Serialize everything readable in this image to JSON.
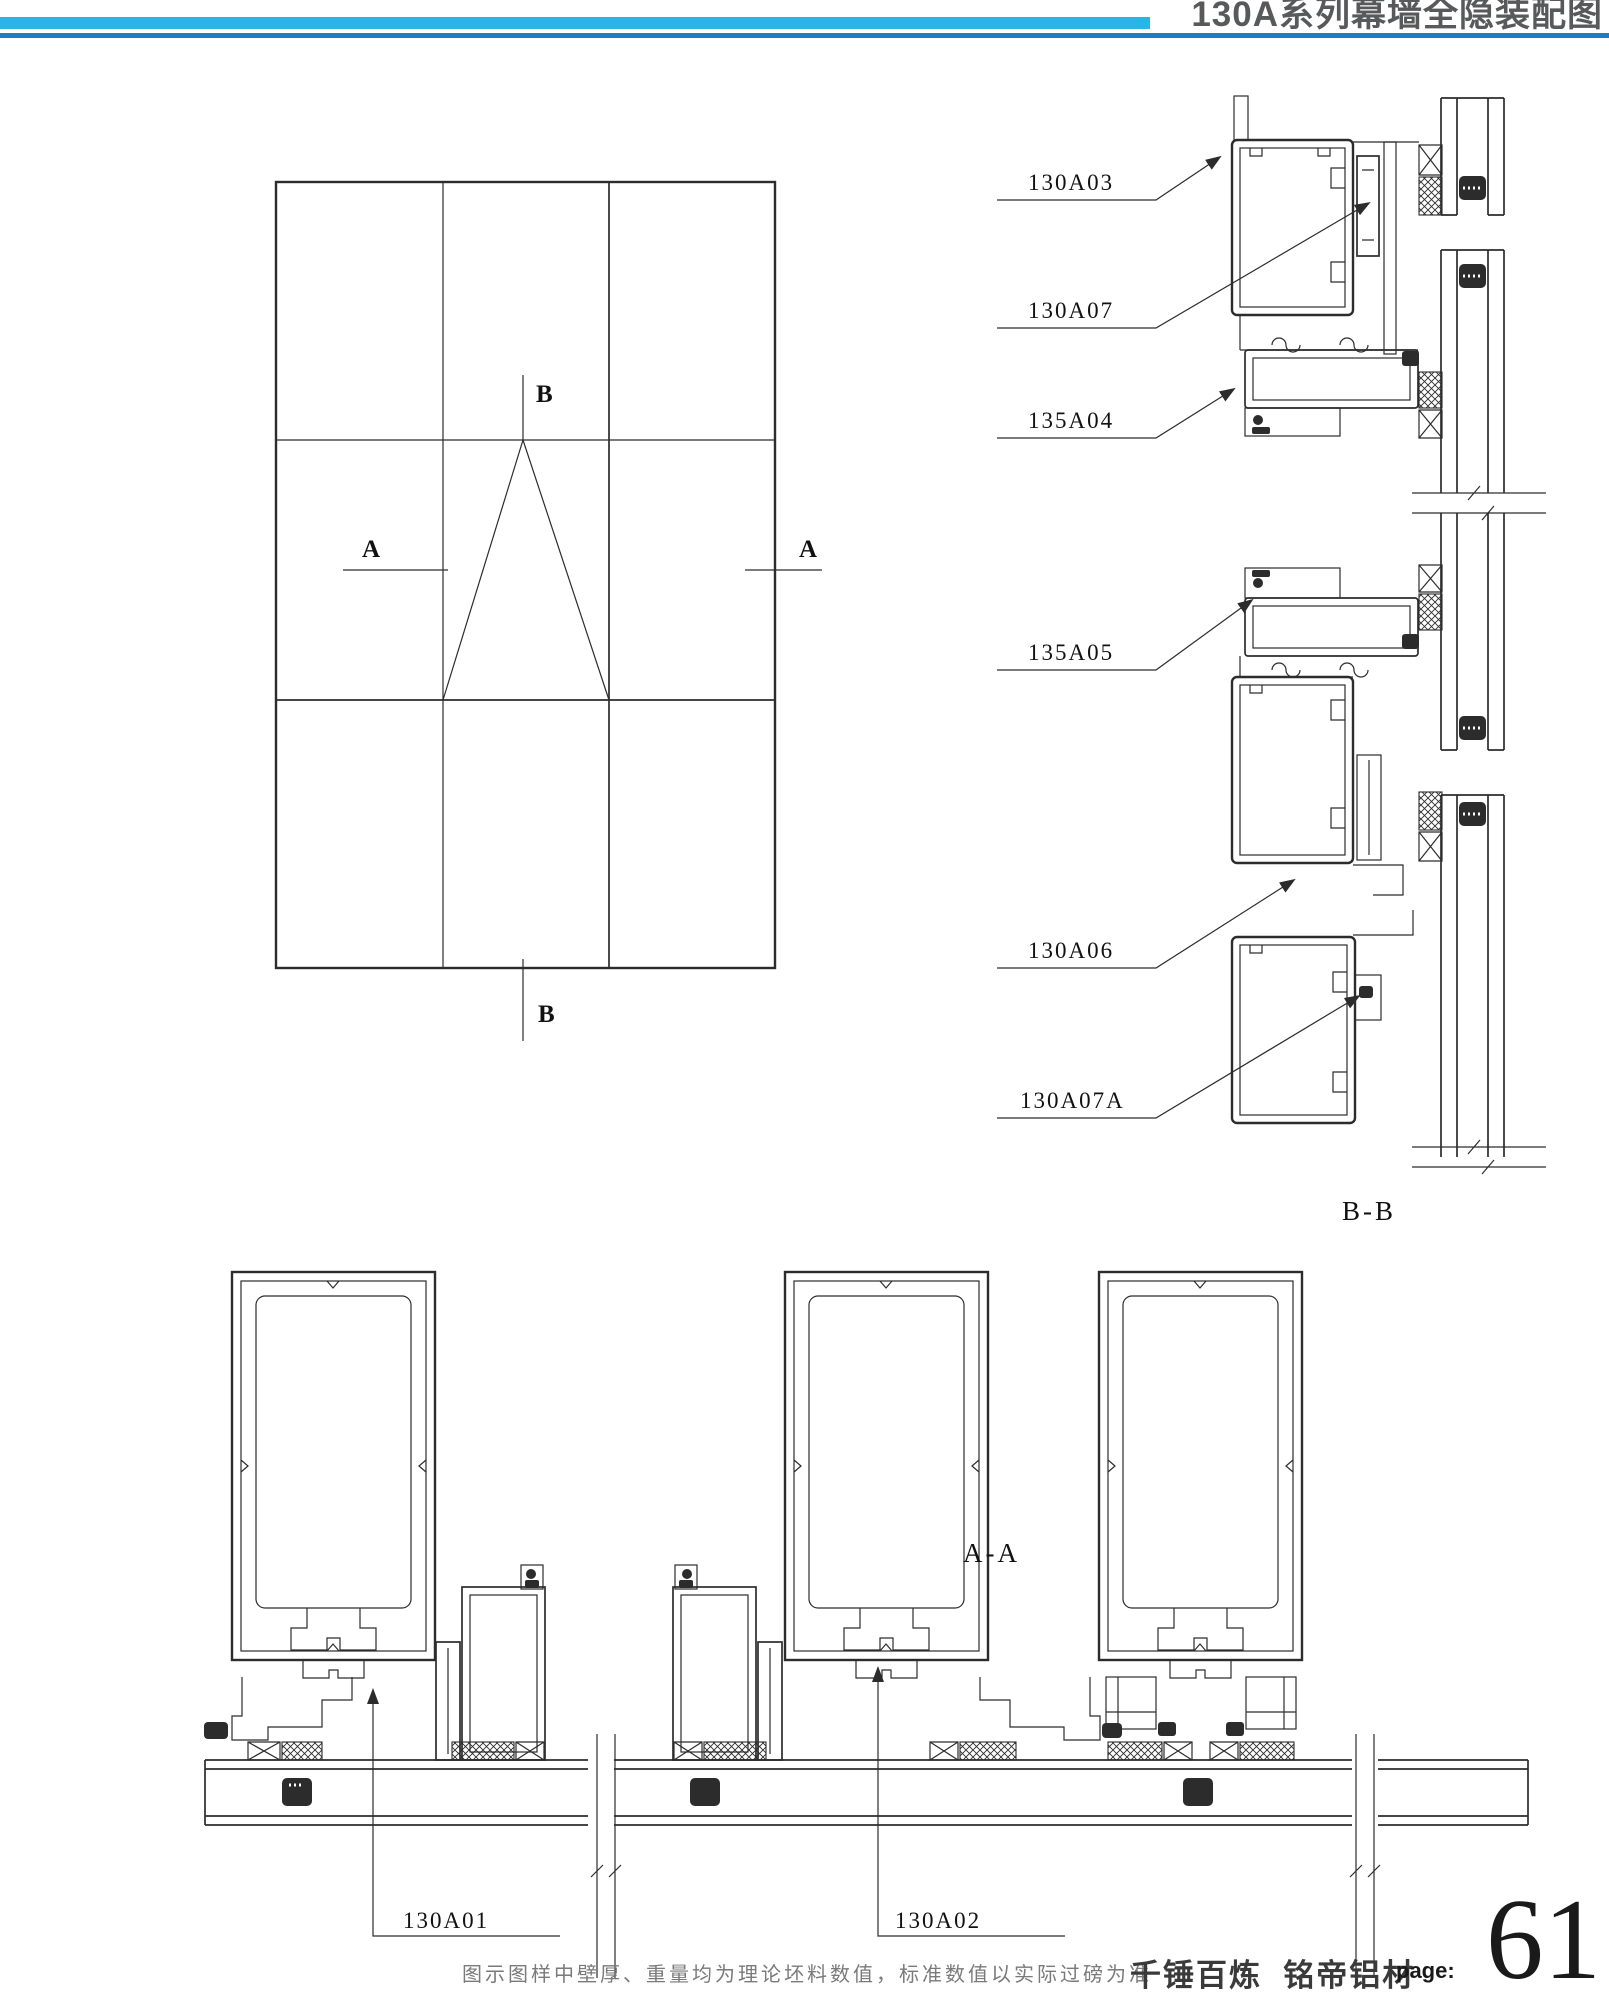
{
  "header": {
    "title": "130A系列幕墙全隐装配图"
  },
  "colors": {
    "accent_cyan": "#29b5e5",
    "accent_blue": "#1f7ec2",
    "title_gray": "#58595b",
    "line_dark": "#2c2c2c"
  },
  "elevation": {
    "section_a": "A",
    "section_b": "B"
  },
  "bb_section": {
    "title": "B-B",
    "part_labels": [
      "130A03",
      "130A07",
      "135A04",
      "135A05",
      "130A06",
      "130A07A"
    ]
  },
  "aa_section": {
    "title": "A-A",
    "part_labels": [
      "130A01",
      "130A02"
    ]
  },
  "footer": {
    "note": "图示图样中壁厚、重量均为理论坯料数值，标准数值以实际过磅为准",
    "brand": "千锤百炼  铭帝铝材",
    "page_label": "page:",
    "page_number": "61"
  }
}
